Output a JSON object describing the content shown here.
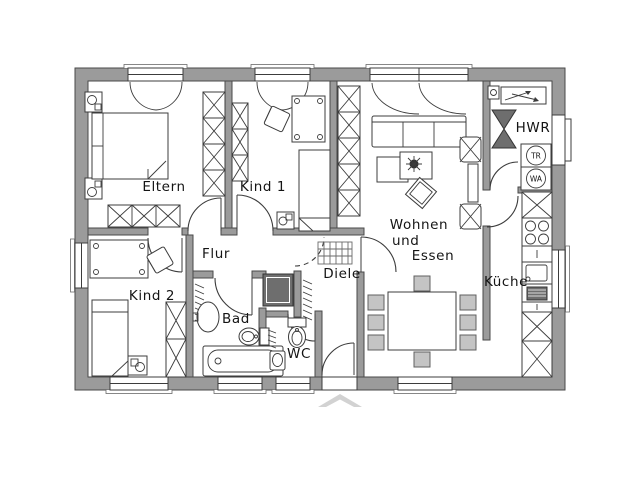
{
  "plan": {
    "type": "floor-plan",
    "rooms": {
      "eltern": "Eltern",
      "kind1": "Kind 1",
      "kind2": "Kind 2",
      "flur": "Flur",
      "diele": "Diele",
      "bad": "Bad",
      "wc": "WC",
      "wohnen_line1": "Wohnen",
      "wohnen_line2": "und",
      "wohnen_line3": "Essen",
      "kueche": "Küche",
      "hwr": "HWR"
    },
    "appliances": {
      "dryer": "TR",
      "washer": "WA"
    },
    "colors": {
      "background": "#ffffff",
      "wall": "#9b9b9b",
      "wall_edge": "#4a4a4a",
      "linework": "#3c3c3c",
      "dark_fixture": "#6e6e6e",
      "chair_fill": "#c4c4c4",
      "entrance_arrow": "#d2d2d2"
    }
  }
}
